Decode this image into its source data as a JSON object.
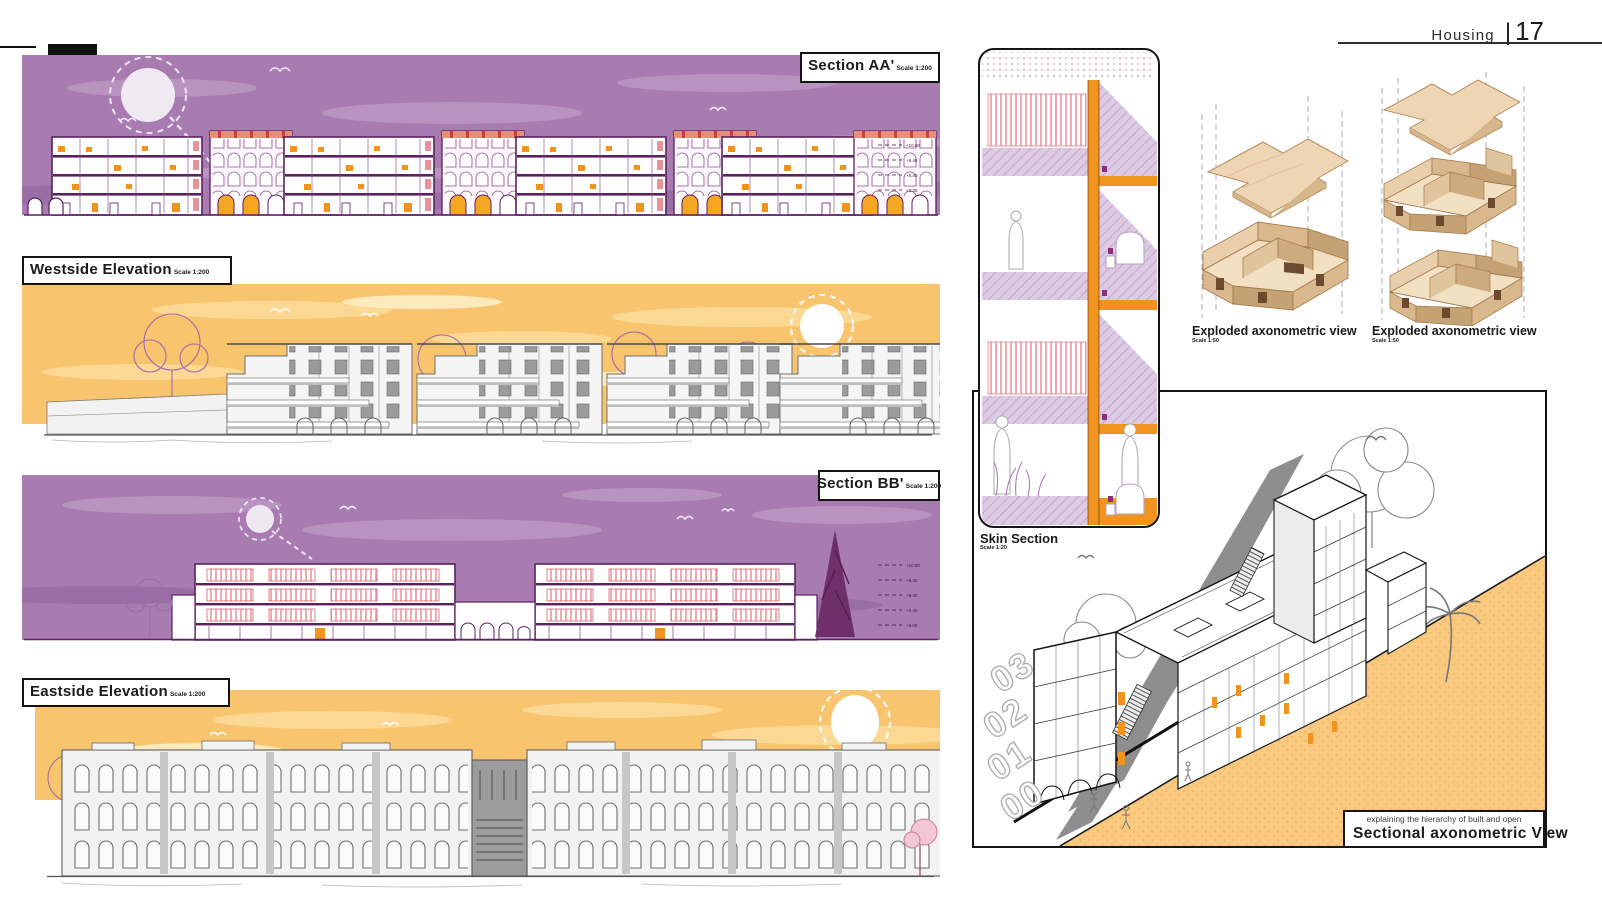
{
  "header": {
    "section_label": "Housing",
    "divider": "|",
    "page_number": "17"
  },
  "panels": {
    "section_aa": {
      "title": "Section AA'",
      "scale": "Scale 1:200",
      "level_marks": [
        "+10.50",
        "+9.40",
        "+6.40",
        "+3.40"
      ]
    },
    "westside_elevation": {
      "title": "Westside Elevation",
      "scale": "Scale 1:200"
    },
    "section_bb": {
      "title": "Section BB'",
      "scale": "Scale 1:200",
      "level_marks": [
        "+10.50",
        "+9.40",
        "+6.40",
        "+3.40",
        "+0.00"
      ]
    },
    "eastside_elevation": {
      "title": "Eastside Elevation",
      "scale": "Scale 1:200"
    },
    "skin_section": {
      "title": "Skin Section",
      "scale": "Scale 1:20"
    },
    "exploded_axo_left": {
      "title": "Exploded axonometric view",
      "scale": "Scale 1:50"
    },
    "exploded_axo_right": {
      "title": "Exploded axonometric view",
      "scale": "Scale 1:50"
    },
    "sectional_axo": {
      "caption_line": "explaining the hierarchy of built and open",
      "title": "Sectional axonometric View",
      "level_numbers": [
        "03",
        "02",
        "01",
        "00"
      ]
    }
  },
  "colors": {
    "purple_sky": "#a87cb0",
    "orange_sky": "#f8c46e",
    "accent_orange": "#f0931f",
    "line_purple": "#5a2060",
    "wood": "#ead2b0",
    "shadow_gray": "#8e8e8e"
  }
}
